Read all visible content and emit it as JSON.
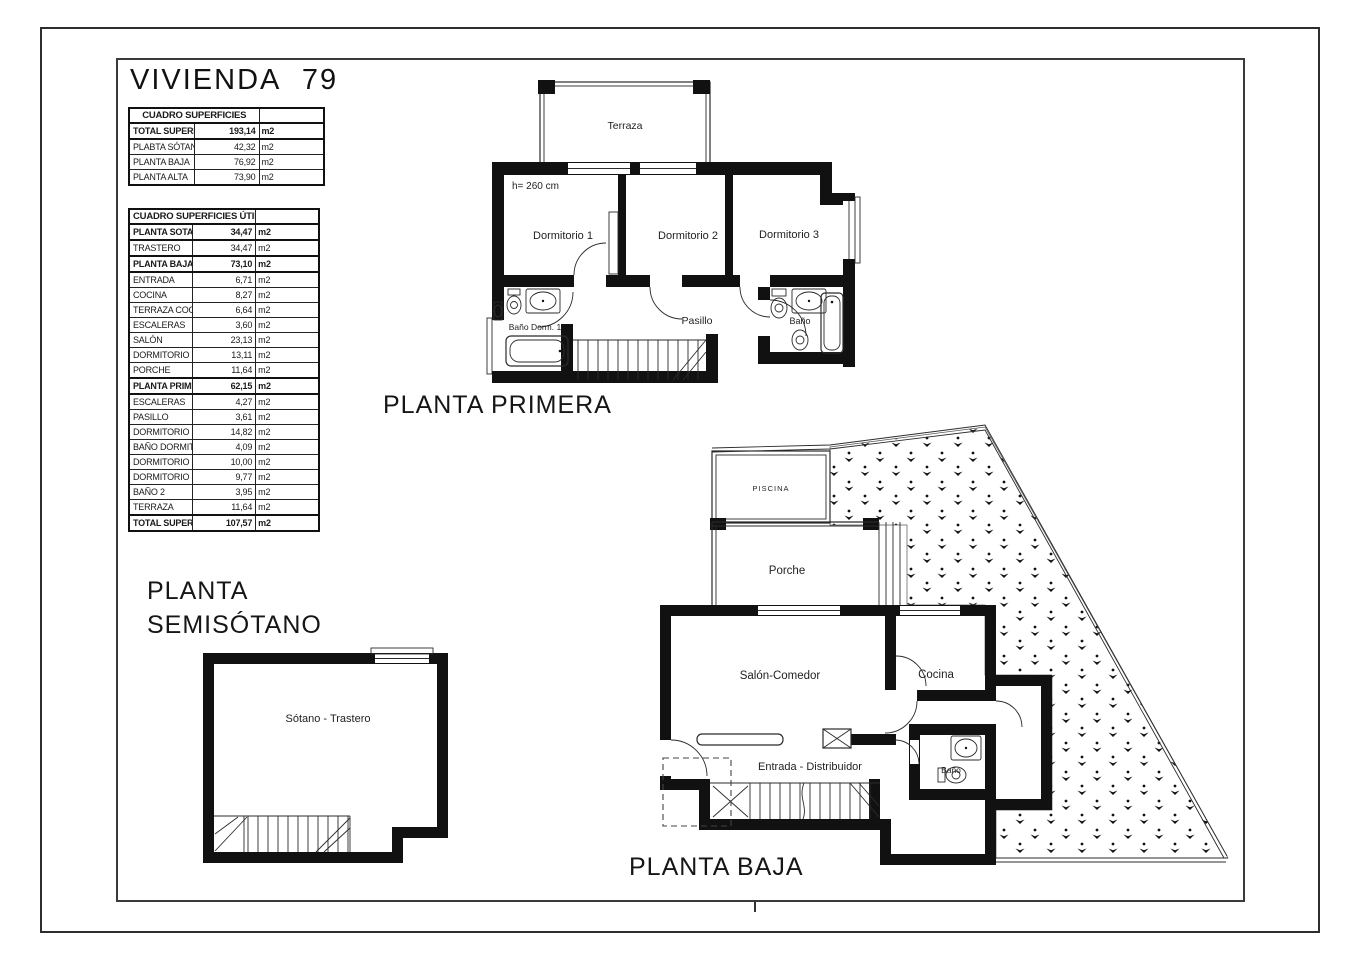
{
  "page": {
    "title": "VIVIENDA 79"
  },
  "tables": {
    "built": {
      "title": "CUADRO SUPERFICIES",
      "unit": "m2",
      "rows": [
        {
          "label": "TOTAL SUPERFICIE CONSTRUIDA",
          "value": "193,14",
          "bold": true
        },
        {
          "label": "PLABTA SÓTANO",
          "value": "42,32",
          "bold": false
        },
        {
          "label": "PLANTA BAJA",
          "value": "76,92",
          "bold": false
        },
        {
          "label": "PLANTA ALTA",
          "value": "73,90",
          "bold": false
        }
      ]
    },
    "useful": {
      "title": "CUADRO SUPERFICIES ÚTILES",
      "unit": "m2",
      "rows": [
        {
          "label": "PLANTA SOTANO",
          "value": "34,47",
          "bold": true
        },
        {
          "label": "TRASTERO",
          "value": "34,47",
          "bold": false
        },
        {
          "label": "PLANTA BAJA",
          "value": "73,10",
          "bold": true
        },
        {
          "label": "ENTRADA",
          "value": "6,71",
          "bold": false
        },
        {
          "label": "COCINA",
          "value": "8,27",
          "bold": false
        },
        {
          "label": "TERRAZA COCINA",
          "value": "6,64",
          "bold": false
        },
        {
          "label": "ESCALERAS",
          "value": "3,60",
          "bold": false
        },
        {
          "label": "SALÓN",
          "value": "23,13",
          "bold": false
        },
        {
          "label": "DORMITORIO 3",
          "value": "13,11",
          "bold": false
        },
        {
          "label": "PORCHE",
          "value": "11,64",
          "bold": false
        },
        {
          "label": "PLANTA PRIMERA",
          "value": "62,15",
          "bold": true
        },
        {
          "label": "ESCALERAS",
          "value": "4,27",
          "bold": false
        },
        {
          "label": "PASILLO",
          "value": "3,61",
          "bold": false
        },
        {
          "label": "DORMITORIO 1",
          "value": "14,82",
          "bold": false
        },
        {
          "label": "BAÑO DORMITORIO 1",
          "value": "4,09",
          "bold": false
        },
        {
          "label": "DORMITORIO 2",
          "value": "10,00",
          "bold": false
        },
        {
          "label": "DORMITORIO 3",
          "value": "9,77",
          "bold": false
        },
        {
          "label": "BAÑO 2",
          "value": "3,95",
          "bold": false
        },
        {
          "label": "TERRAZA",
          "value": "11,64",
          "bold": false
        },
        {
          "label": "TOTAL SUPERFICIE ÚTIL",
          "value": "107,57",
          "bold": true
        }
      ]
    }
  },
  "plans": {
    "primera": {
      "title": "PLANTA PRIMERA",
      "labels": {
        "terraza": "Terraza",
        "height_note": "h= 260 cm",
        "dorm1": "Dormitorio 1",
        "dorm2": "Dormitorio 2",
        "dorm3": "Dormitorio 3",
        "pasillo": "Pasillo",
        "bano": "Baño",
        "bano_dorm1": "Baño Dorm. 1"
      }
    },
    "baja": {
      "title": "PLANTA BAJA",
      "labels": {
        "piscina": "PISCINA",
        "porche": "Porche",
        "salon": "Salón-Comedor",
        "cocina": "Cocina",
        "entrada": "Entrada - Distribuidor",
        "bano": "Baño"
      }
    },
    "semisotano": {
      "title_line1": "PLANTA",
      "title_line2": "SEMISÓTANO",
      "labels": {
        "sotano": "Sótano - Trastero"
      }
    }
  }
}
